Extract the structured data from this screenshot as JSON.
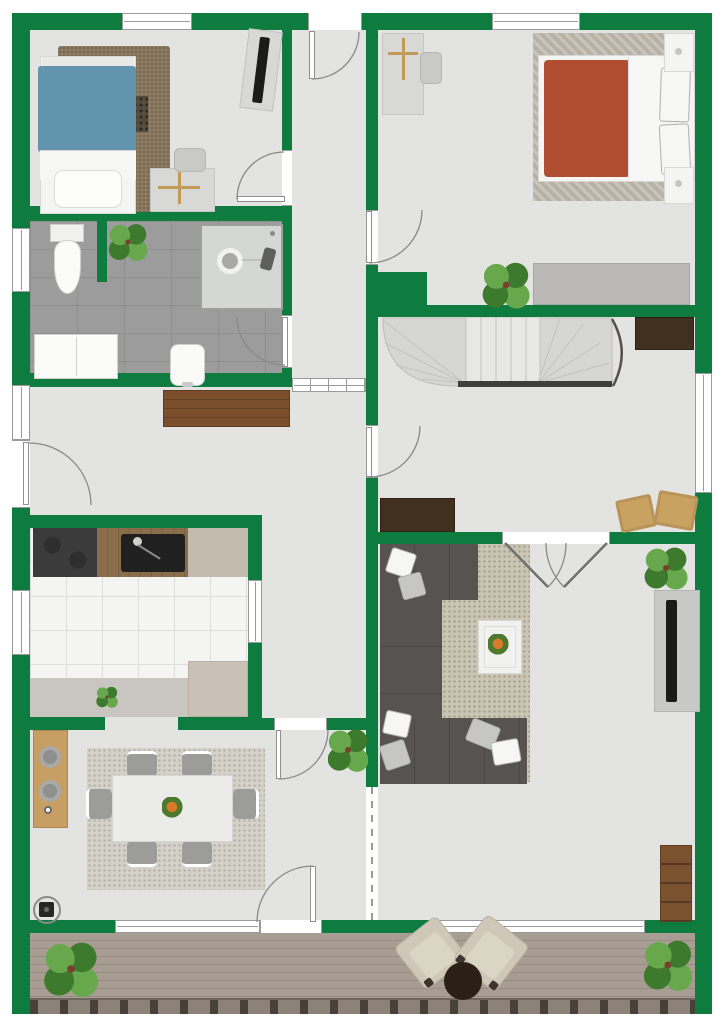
{
  "plan": {
    "description": "2D top-down residential floor plan with green walls, upper floor with deck",
    "rooms": [
      {
        "name": "bedroom-1",
        "position": "top-left",
        "furniture": [
          "single-bed-blue",
          "shag-rug",
          "rug-pattern-mat",
          "desk",
          "desk-chair",
          "wall-tv"
        ]
      },
      {
        "name": "bedroom-2",
        "position": "top-right",
        "furniture": [
          "double-bed-red",
          "herringbone-rug",
          "nightstand-left",
          "nightstand-right",
          "desk",
          "desk-chair",
          "wardrobe",
          "potted-plant"
        ]
      },
      {
        "name": "bathroom",
        "position": "middle-left",
        "furniture": [
          "toilet",
          "shower-cabin",
          "bidet",
          "double-cabinet",
          "potted-plant",
          "privacy-stub-wall"
        ]
      },
      {
        "name": "entry-corridor",
        "position": "top-center",
        "furniture": [
          "glazed-partition"
        ]
      },
      {
        "name": "hallway",
        "position": "middle-left",
        "furniture": [
          "wood-dresser"
        ]
      },
      {
        "name": "stair-hall",
        "position": "middle-right",
        "furniture": [
          "winder-staircase",
          "handrail",
          "curved-rail",
          "sideboard-top-right",
          "sideboard-bottom-left",
          "pouf",
          "pouf"
        ]
      },
      {
        "name": "kitchen",
        "position": "lower-middle-left",
        "furniture": [
          "cooktop",
          "wood-counter-with-sink",
          "beige-counter",
          "floor-mat",
          "island-block",
          "potted-plant"
        ]
      },
      {
        "name": "dining-room",
        "position": "bottom-left",
        "furniture": [
          "dining-table",
          "dining-chair",
          "dining-chair",
          "dining-chair",
          "dining-chair",
          "dining-chair",
          "dining-chair",
          "tan-sideboard",
          "wood-stove",
          "potted-plant",
          "rug",
          "table-centerpiece"
        ]
      },
      {
        "name": "living-room",
        "position": "bottom-right",
        "furniture": [
          "corner-sofa",
          "throw-pillow",
          "throw-pillow",
          "throw-pillow",
          "throw-pillow",
          "throw-pillow",
          "throw-pillow",
          "coffee-table",
          "rug",
          "tv-panel",
          "bookshelf",
          "potted-plant",
          "open-passage-dashed-line"
        ]
      },
      {
        "name": "deck",
        "position": "bottom",
        "furniture": [
          "armchair",
          "armchair",
          "round-side-table",
          "potted-plant",
          "potted-plant",
          "plank-decking",
          "edge-fascia"
        ]
      }
    ],
    "doors": [
      "entrance-door-top-of-corridor",
      "bedroom-1-door",
      "bedroom-2-door",
      "bathroom-door",
      "hallway-exterior-door-left",
      "stair-hall-door",
      "dining-room-door",
      "dining-terrace-door",
      "living-room-double-door"
    ],
    "windows": [
      "bedroom-1-top-window",
      "bedroom-2-top-window",
      "bathroom-left-window",
      "hallway-left-window",
      "kitchen-left-window",
      "kitchen-pass-through-window",
      "stair-hall-right-window",
      "dining-bottom-window",
      "living-bottom-window",
      "corridor-glazed-partition"
    ]
  },
  "colors": {
    "wall": "#0e7c3e",
    "floor": "#e3e3e1",
    "outside": "#ffffff",
    "bath_tile": "#9c9c9c",
    "bath_grout": "#8f8f8f",
    "kitchen_tile": "#f4f4f2",
    "kitchen_grid": "#dedede",
    "mat": "#c9c6c1",
    "deck": "#a89d93",
    "deck_line": "#978c82",
    "fascia": "#8c8278",
    "post": "#474139",
    "window_frame": "#9a9a9a",
    "door_arc": "#8a8a8a",
    "wood_dresser": "#7b4f2c",
    "dark_sideboard": "#41301f",
    "tan_sideboard": "#c79e63",
    "sofa": "#575350",
    "rug_bed1": "#8d7b62",
    "rug_bed2": "#b7b2a5",
    "rug_dining": "#d3d1c8",
    "rug_living": "#cbc5b4",
    "bed1_blanket": "#6394ad",
    "bed2_blanket": "#b14e31",
    "white_furn": "#f4f4f2",
    "stair": "#d6d6d4",
    "stair_line": "#c2c2c0",
    "rail": "#3f3f3d",
    "tv": "#1b1b1b",
    "panel": "#c8c8c6",
    "stove": "#3b3b3b",
    "counter_wood": "#8a6e4b",
    "counter_beige": "#c3bbae",
    "sink": "#202020",
    "wardrobe": "#bab9b7",
    "table": "#ebebe9",
    "chair": "#9c9c9a",
    "plant_dark": "#3e7a2e",
    "plant_light": "#67a84c",
    "shower": "#d5d7d5",
    "desk": "#d8d8d6",
    "accent_tan": "#c49a58",
    "pouf": "#c9a161",
    "deck_chair": "#cfc8b8",
    "round_table": "#2b2015",
    "bookshelf": "#7a5230",
    "gray_block": "#c9c1b5"
  }
}
